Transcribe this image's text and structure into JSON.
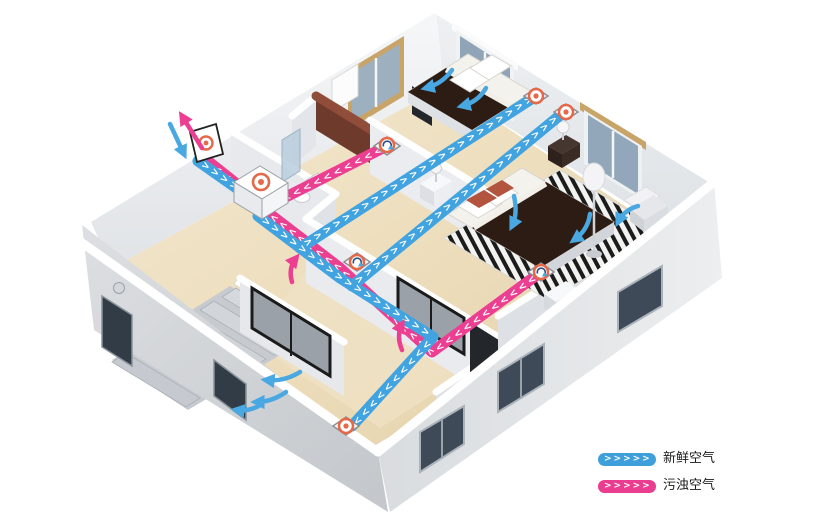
{
  "legend": {
    "items": [
      {
        "id": "fresh-air",
        "label": "新鲜空气",
        "chevrons": ">>>>>",
        "color": "#3f9fdb"
      },
      {
        "id": "exhaust-air",
        "label": "污浊空气",
        "chevrons": ">>>>>",
        "color": "#ea3d8f"
      }
    ]
  },
  "ducts": {
    "fresh_color": "#41a3e0",
    "exhaust_color": "#ec3f92",
    "vent_color": "#e4684a",
    "pink_trunk_chevrons": ">>>>>>>>>>>>>>>>>>>>>>>>>>>>>>>>>>",
    "pink_bath_chevrons": ">>>>>>>>>>>>>",
    "pink_stub_chevrons": ">>>>",
    "blue_in_chevrons": ">>>>>",
    "blue_trunk_chevrons": ">>>>>>>>>>>>>>>>>>>>>",
    "blue_desc_chevrons": ">>>>>>>>>>>>",
    "blue_branch_a_chevrons": ">>>>>>>>>>>>>>>>>>>>>>>>>>",
    "blue_branch_b_chevrons": ">>>>>>>>>>>>>>>>>>>>>>>>>>"
  }
}
